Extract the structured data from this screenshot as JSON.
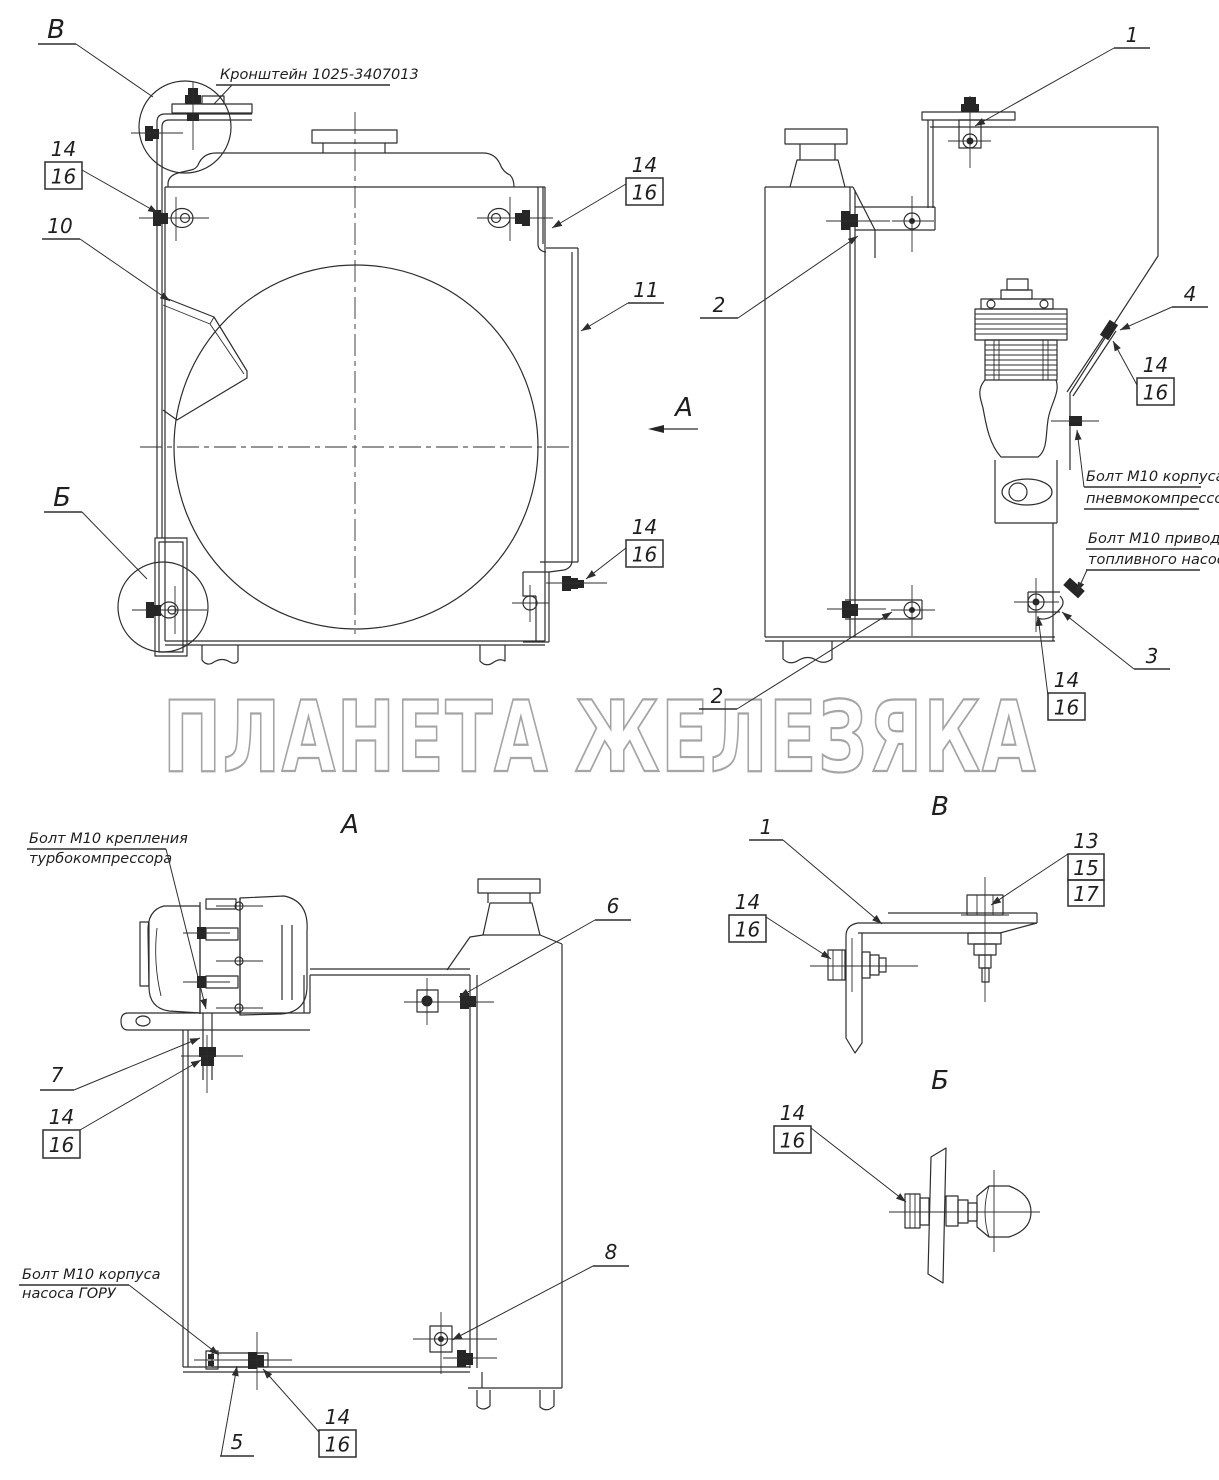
{
  "sheet": {
    "watermark": "ПЛАНЕТА ЖЕЛЕЗЯКА"
  },
  "view_titles": {
    "view_a": "А",
    "view_v": "В",
    "view_b": "Б"
  },
  "direction_label": "А",
  "detail_markers": {
    "v": "В",
    "b": "Б"
  },
  "callouts": {
    "n1": "1",
    "n2": "2",
    "n3": "3",
    "n4": "4",
    "n5": "5",
    "n6": "6",
    "n7": "7",
    "n8": "8",
    "n10": "10",
    "n11": "11",
    "n13": "13",
    "n14": "14",
    "n15": "15",
    "n16": "16",
    "n17": "17"
  },
  "part_labels": {
    "bracket": "Кронштейн 1025-3407013",
    "bolt_pneumo_line1": "Болт М10 корпуса",
    "bolt_pneumo_line2": "пневмокомпрессора",
    "bolt_fuel_line1": "Болт М10 привода",
    "bolt_fuel_line2": "топливного насоса",
    "bolt_turbo_line1": "Болт М10 крепления",
    "bolt_turbo_line2": "турбокомпрессора",
    "bolt_goru_line1": "Болт М10 корпуса",
    "bolt_goru_line2": "насоса ГОРУ"
  }
}
